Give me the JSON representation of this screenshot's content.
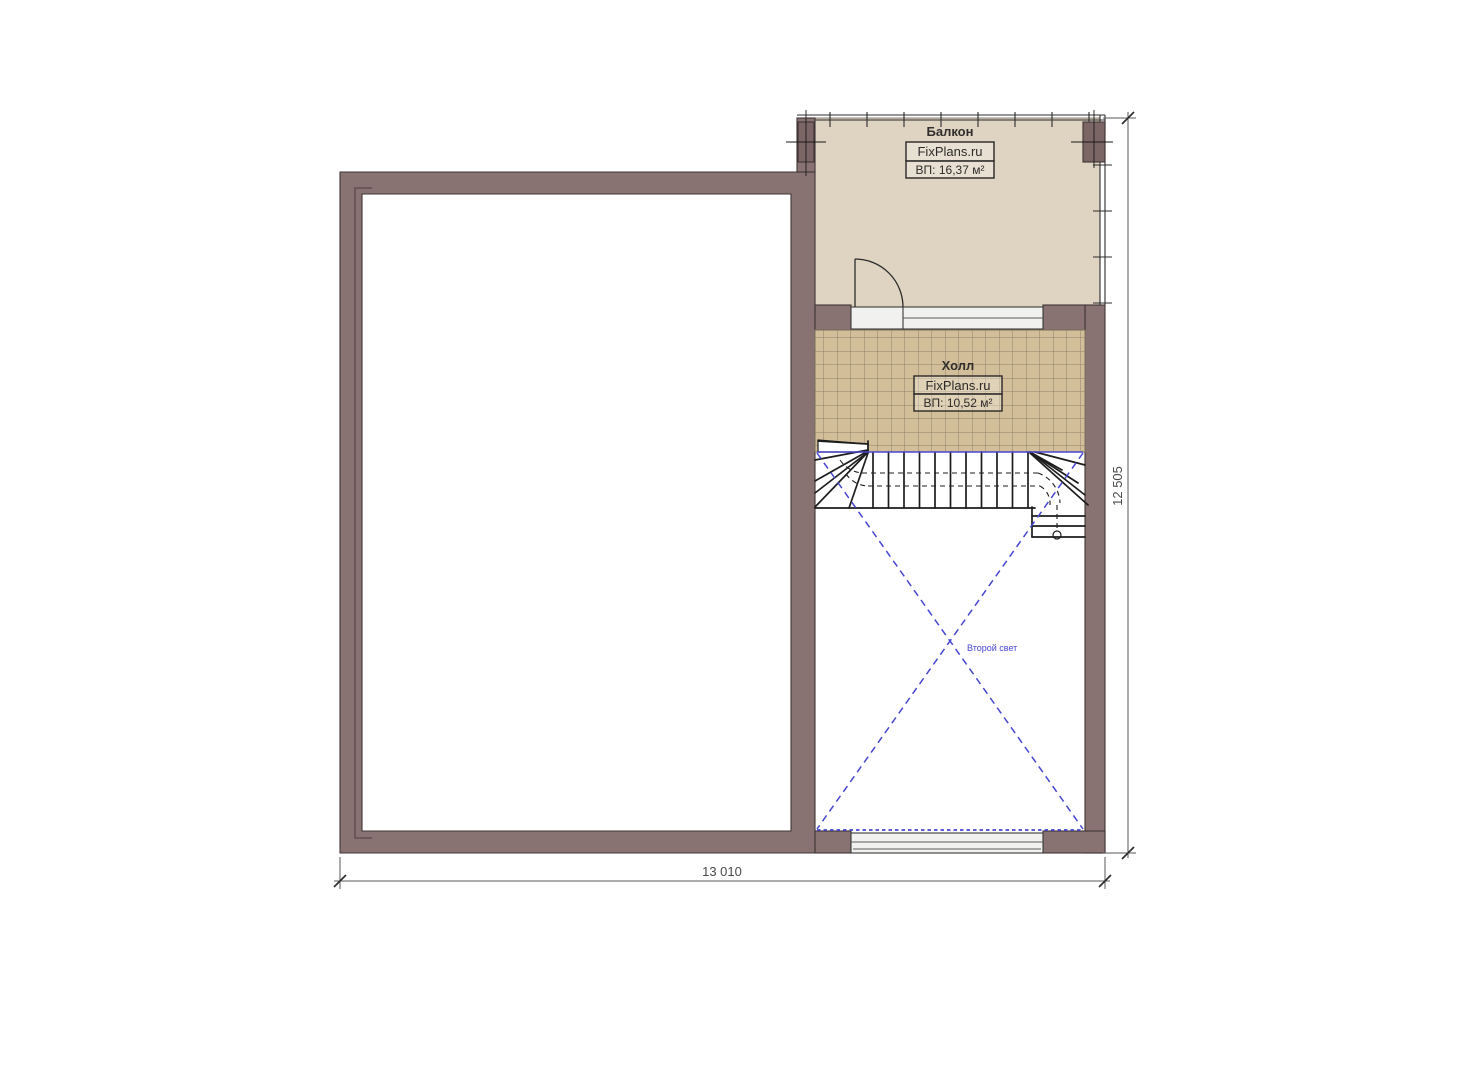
{
  "plan": {
    "rooms": {
      "balcony": {
        "name": "Балкон",
        "brand": "FixPlans.ru",
        "area": "ВП: 16,37 м²"
      },
      "hall": {
        "name": "Холл",
        "brand": "FixPlans.ru",
        "area": "ВП: 10,52 м²"
      },
      "void": {
        "label": "Второй свет"
      }
    },
    "dimensions": {
      "width": "13 010",
      "height": "12 505"
    },
    "colors": {
      "wall": "#887272",
      "column": "#7b6565",
      "wall_outline": "#3f3535",
      "balcony_floor": "#ded4c1",
      "tile": "#d2bf99",
      "tile_line": "#8f8169",
      "window_fill": "#f1f1ef",
      "stair_line": "#1d1d1d",
      "void_blue": "#4646cf",
      "dim_line": "#5a5a5a",
      "text": "#332e2e"
    }
  }
}
